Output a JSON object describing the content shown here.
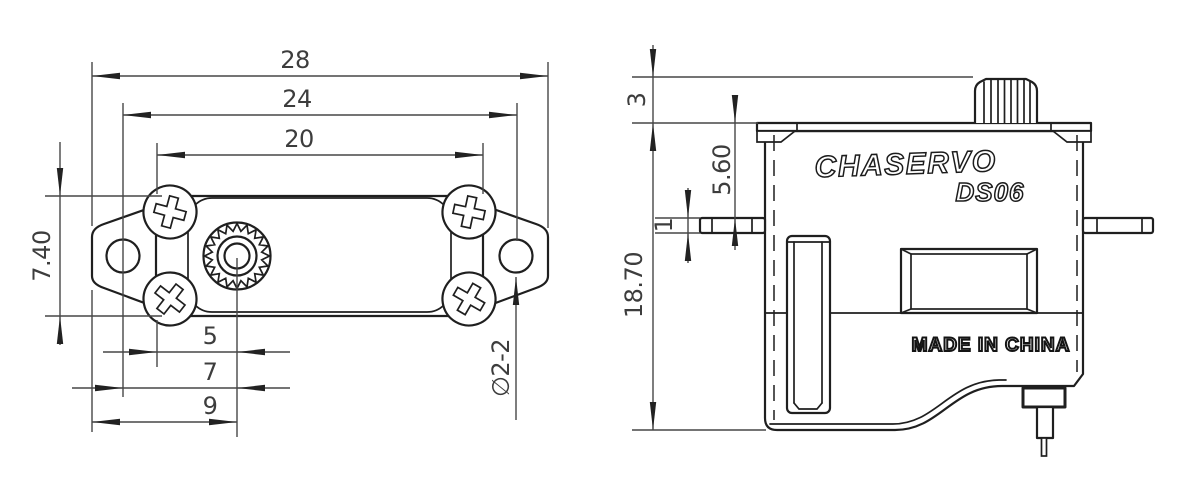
{
  "branding": {
    "logo": "CHASERVO",
    "model": "DS06",
    "origin": "MADE IN CHINA"
  },
  "top_view": {
    "overall_width": "28",
    "hole_spacing": "24",
    "body_width": "20",
    "body_depth": "7.40",
    "shaft_to_body_edge": "5",
    "shaft_to_hole_center": "7",
    "shaft_to_ear_tip": "9",
    "hole_callout": "∅2-2"
  },
  "side_view": {
    "shaft_height": "3",
    "top_to_flange": "5.60",
    "flange_thickness": "1",
    "overall_height": "18.70"
  },
  "colors": {
    "line": "#1f1f1f",
    "dim_text": "#3d3d3d",
    "background": "#ffffff"
  }
}
